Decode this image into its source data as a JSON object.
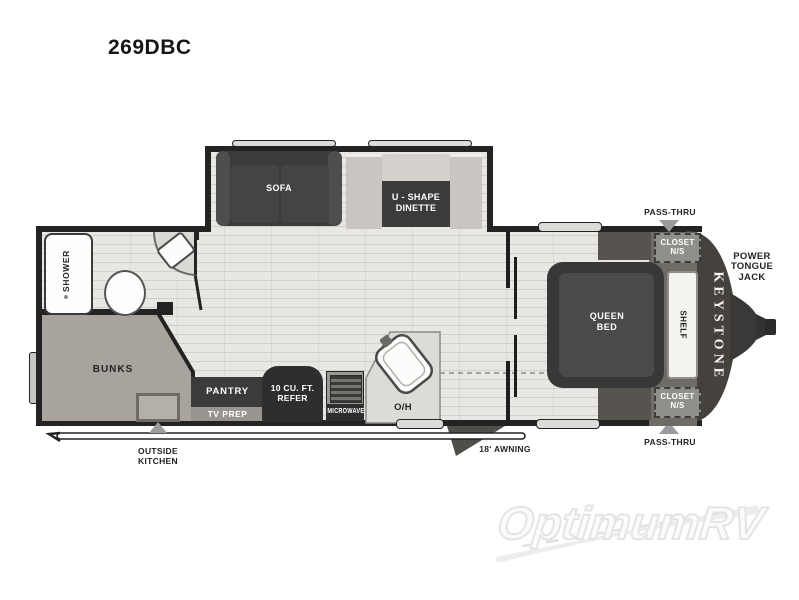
{
  "title": "269DBC",
  "fp": {
    "slideout": {
      "sofa": "SOFA",
      "dinette": [
        "U - SHAPE",
        "DINETTE"
      ]
    },
    "bath": {
      "shower": "SHOWER"
    },
    "bunkroom": {
      "bunks": "BUNKS"
    },
    "kitchen": {
      "pantry": "PANTRY",
      "tv_prep": "TV PREP",
      "refer": [
        "10 CU. FT.",
        "REFER"
      ],
      "microwave": "MICROWAVE",
      "overhead": "O/H"
    },
    "bedroom": {
      "bed": [
        "QUEEN",
        "BED"
      ],
      "shelf": "SHELF",
      "closet_top": [
        "CLOSET",
        "N/S"
      ],
      "closet_bottom": [
        "CLOSET",
        "N/S"
      ]
    },
    "exterior": {
      "pass_thru_top": "PASS-THRU",
      "pass_thru_bottom": "PASS-THRU",
      "tongue_jack": [
        "POWER",
        "TONGUE",
        "JACK"
      ],
      "brand": "KEYSTONE",
      "awning": "18' AWNING",
      "outside_kitchen": [
        "OUTSIDE",
        "KITCHEN"
      ]
    }
  },
  "watermark": {
    "brand": "OptimumRV"
  },
  "colors": {
    "wall": "#232323",
    "floor": "#e8e7e4",
    "dark_furniture": "#3b3b3b",
    "bunks_fill": "#a8a49d",
    "arrow_gray": "#9b9b9b",
    "cap_dark": "#45423e"
  }
}
